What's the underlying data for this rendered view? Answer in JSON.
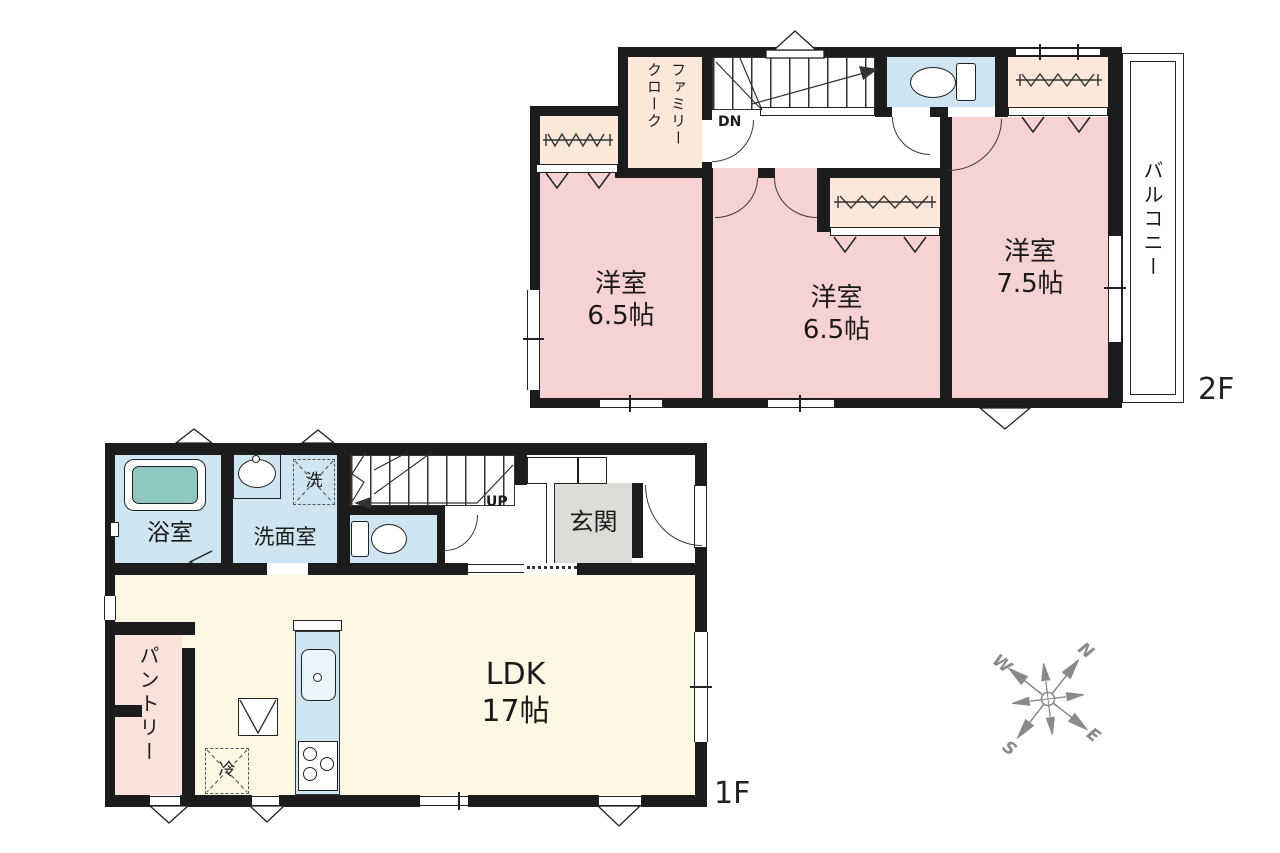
{
  "floor2": {
    "label": "2F",
    "family_closet": {
      "line1": "ファミリー",
      "line2": "クローク"
    },
    "stairs_label": "DN",
    "room_left": {
      "name": "洋室",
      "size": "6.5帖"
    },
    "room_middle": {
      "name": "洋室",
      "size": "6.5帖"
    },
    "room_right": {
      "name": "洋室",
      "size": "7.5帖"
    },
    "balcony": "バルコニー"
  },
  "floor1": {
    "label": "1F",
    "bathroom": "浴室",
    "washroom": "洗面室",
    "washer": "洗",
    "stairs_label": "UP",
    "entrance": "玄関",
    "ldk": {
      "name": "LDK",
      "size": "17帖"
    },
    "pantry": "パントリー",
    "fridge": "冷"
  },
  "compass": {
    "north": "N",
    "east": "E",
    "south": "S",
    "west": "W"
  },
  "colors": {
    "room_pink": "#f6d2d2",
    "closet_cream": "#fbe8da",
    "pantry_pink": "#f8e2da",
    "water_blue": "#cfe5f2",
    "ldk_yellow": "#fcf8e3",
    "entrance_gray": "#dedcd7",
    "tub_teal": "#8fc8c1",
    "wall_black": "#1c1c1c",
    "compass_gray": "#8a8a8a"
  }
}
